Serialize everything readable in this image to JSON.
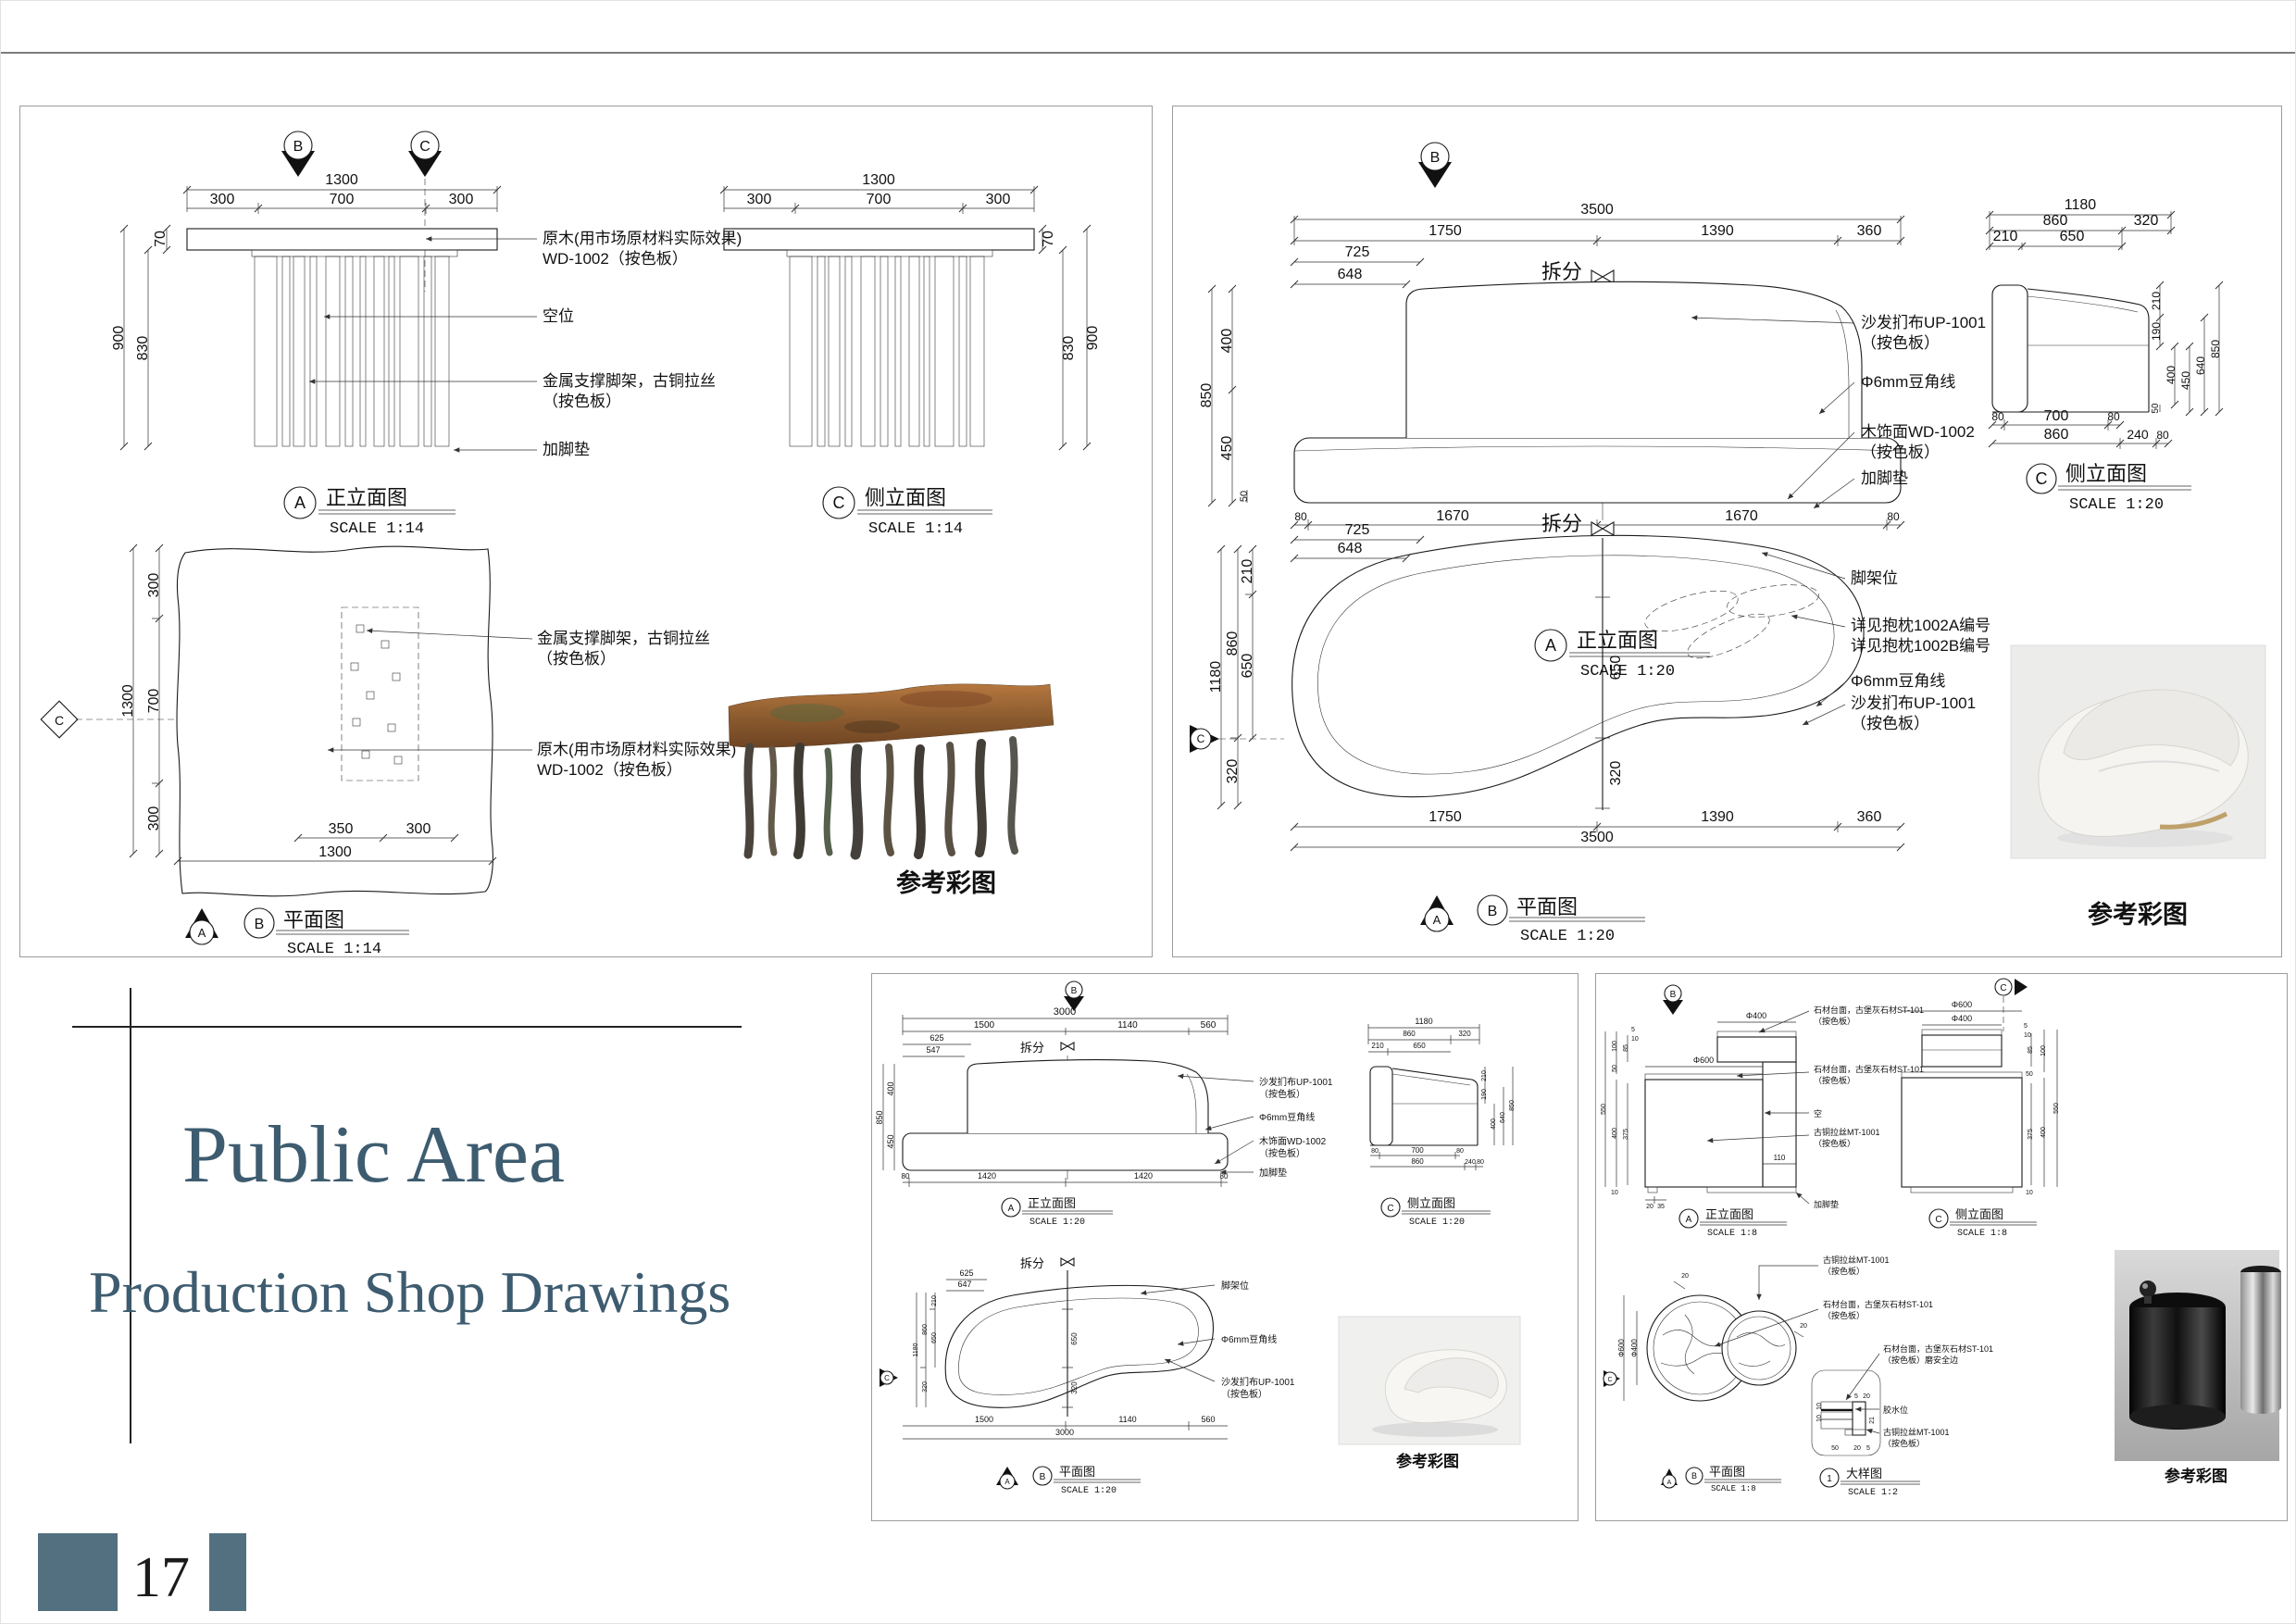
{
  "page": {
    "number": "17"
  },
  "colors": {
    "accent": "#52707f",
    "title_text": "#3e5c70"
  },
  "title": {
    "line1": "Public Area",
    "line2": "Production Shop Drawings"
  },
  "common": {
    "ref": "参考彩图",
    "split": "拆分",
    "front": "正立面图",
    "side": "侧立面图",
    "plan": "平面图",
    "detail": "大样图",
    "s114": "SCALE 1:14",
    "s120": "SCALE 1:20",
    "s18": "SCALE 1:8",
    "s12": "SCALE 1:2",
    "mA": "A",
    "mB": "B",
    "mC": "C",
    "m1": "1"
  },
  "labels": {
    "wood_raw": "原木(用市场原材料实际效果)",
    "wd1002": "WD-1002（按色板）",
    "void_seat": "空位",
    "metal_leg": "金属支撑脚架，古铜拉丝",
    "anseban": "（按色板）",
    "pad": "加脚垫",
    "fabric": "沙发扪布UP-1001",
    "bead": "Φ6mm豆角线",
    "veneer": "木饰面WD-1002",
    "legpos": "脚架位",
    "pillowA": "详见抱枕1002A编号",
    "pillowB": "详见抱枕1002B编号",
    "stone_top": "石材台面，古堡灰石材ST-101",
    "safe_edge": "（按色板）磨安全边",
    "void": "空",
    "metal": "古铜拉丝MT-1001",
    "glue": "胶水位"
  },
  "dims": {
    "d5": "5",
    "d10": "10",
    "d20": "20",
    "d21": "21",
    "d35": "35",
    "d50": "50",
    "d70": "70",
    "d80": "80",
    "d85": "85",
    "d100": "100",
    "d110": "110",
    "d190": "190",
    "d210": "210",
    "d240": "240",
    "d300": "300",
    "d320": "320",
    "d350": "350",
    "d360": "360",
    "d375": "375",
    "d400": "400",
    "d450": "450",
    "d547": "547",
    "d550": "550",
    "d560": "560",
    "d625": "625",
    "d640": "640",
    "d647": "647",
    "d648": "648",
    "d650": "650",
    "d700": "700",
    "d725": "725",
    "d830": "830",
    "d850": "850",
    "d860": "860",
    "d900": "900",
    "d1140": "1140",
    "d1180": "1180",
    "d1300": "1300",
    "d1390": "1390",
    "d1420": "1420",
    "d1500": "1500",
    "d1670": "1670",
    "d1750": "1750",
    "d3000": "3000",
    "d3500": "3500",
    "dia400": "Φ400",
    "dia600": "Φ600"
  }
}
